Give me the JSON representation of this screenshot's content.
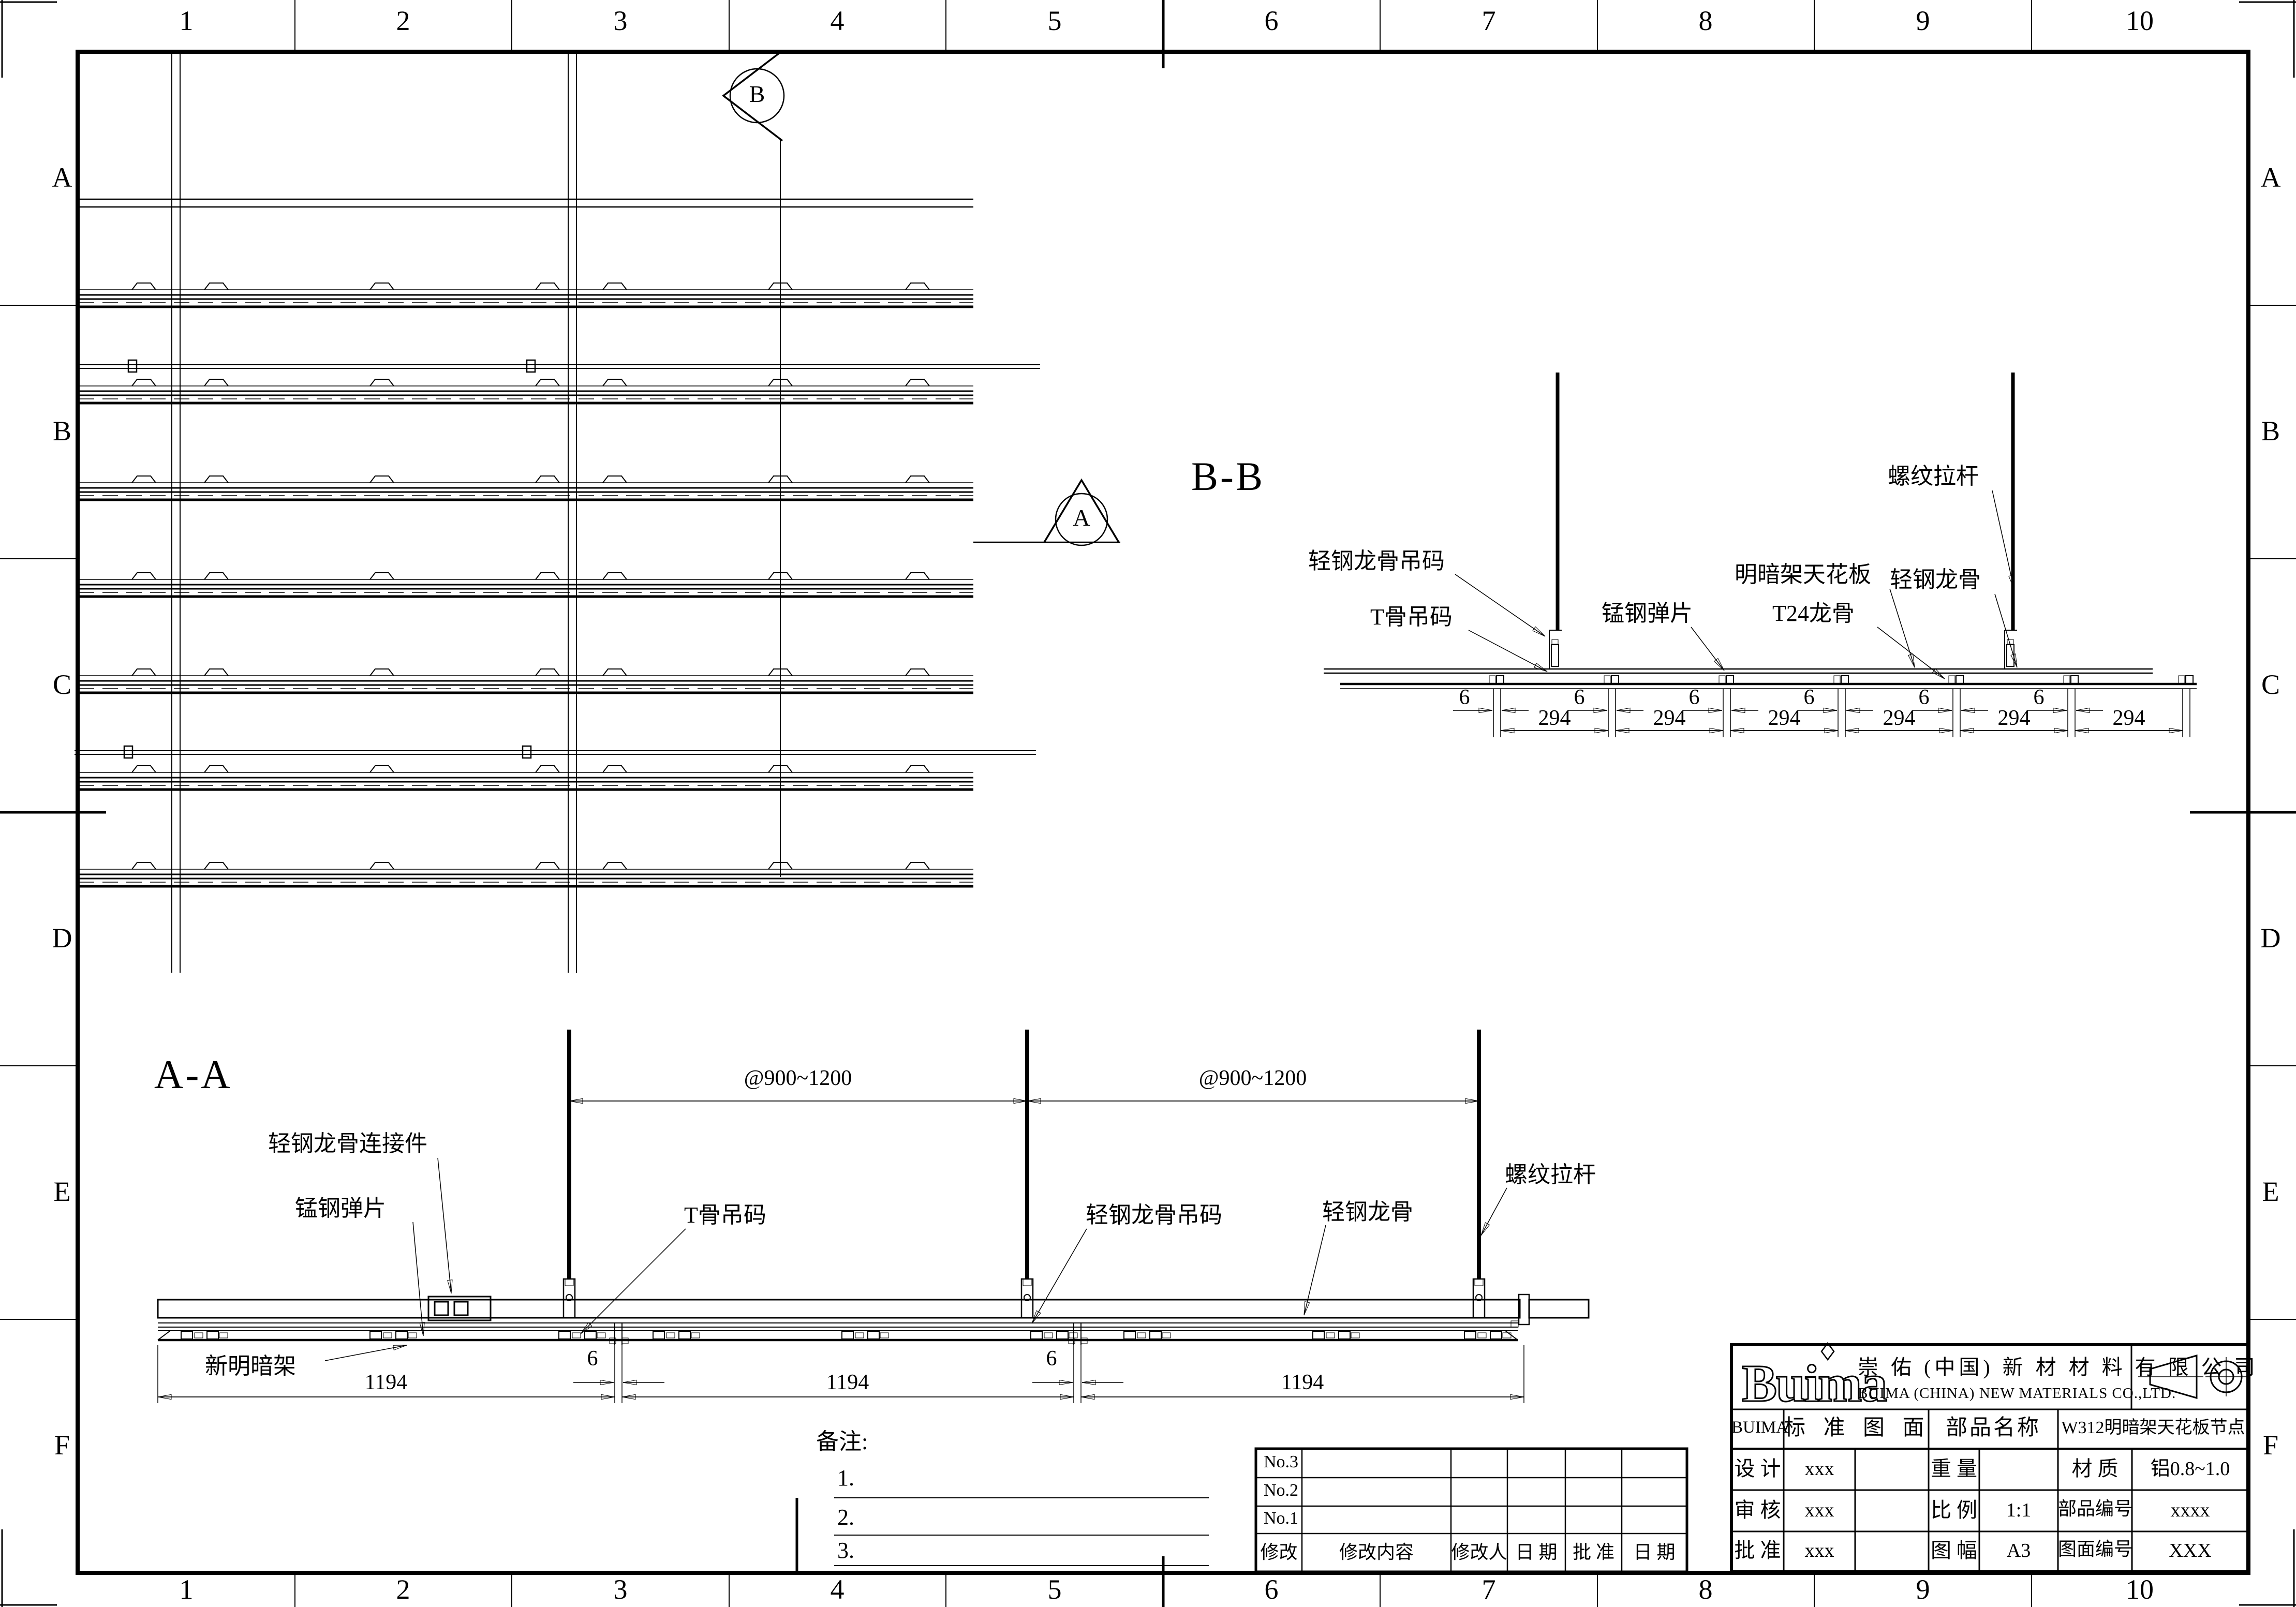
{
  "ink": "#000000",
  "paper": "#ffffff",
  "grid": {
    "cols": [
      "1",
      "2",
      "3",
      "4",
      "5",
      "6",
      "7",
      "8",
      "9",
      "10"
    ],
    "rows": [
      "A",
      "B",
      "C",
      "D",
      "E",
      "F"
    ]
  },
  "plan": {
    "section_marker_b": "B",
    "section_marker_a": "A"
  },
  "bb": {
    "title": "B-B",
    "labels": {
      "keel_hanger": "轻钢龙骨吊码",
      "tbar_hanger": "T骨吊码",
      "spring_clip": "锰钢弹片",
      "ceiling_panel": "明暗架天花板",
      "t24_runner": "T24龙骨",
      "threaded_rod": "螺纹拉杆",
      "steel_keel": "轻钢龙骨"
    },
    "dim_6": "6",
    "dim_294": "294"
  },
  "aa": {
    "title": "A-A",
    "labels": {
      "keel_connector": "轻钢龙骨连接件",
      "spring_clip": "锰钢弹片",
      "tbar_hanger": "T骨吊码",
      "keel_hanger": "轻钢龙骨吊码",
      "steel_keel": "轻钢龙骨",
      "threaded_rod": "螺纹拉杆",
      "new_frame": "新明暗架"
    },
    "dim_span": "@900~1200",
    "dim_1194": "1194",
    "dim_6": "6"
  },
  "notes": {
    "title": "备注:",
    "item1": "1.",
    "item2": "2.",
    "item3": "3."
  },
  "revision": {
    "rows": [
      "No.3",
      "No.2",
      "No.1"
    ],
    "headers": [
      "修改",
      "修改内容",
      "修改人",
      "日 期",
      "批 准",
      "日 期"
    ]
  },
  "title_block": {
    "logo": "Buima",
    "company_cn": "崇 佑 (中国) 新 材 材 料 有 限 公 司",
    "company_en": "BUIMA (CHINA) NEW MATERIALS CO.,LTD.",
    "brand": "BUIMA",
    "std_drawing": "标 准 图 面",
    "part_name_label": "部品名称",
    "part_name": "W312明暗架天花板节点",
    "design_label": "设 计",
    "design_value": "xxx",
    "weight_label": "重 量",
    "weight_value": "",
    "material_label": "材  质",
    "material_value": "铝0.8~1.0",
    "check_label": "审 核",
    "check_value": "xxx",
    "scale_label": "比 例",
    "scale_value": "1:1",
    "part_no_label": "部品编号",
    "part_no_value": "xxxx",
    "approve_label": "批 准",
    "approve_value": "xxx",
    "size_label": "图 幅",
    "size_value": "A3",
    "dwg_no_label": "图面编号",
    "dwg_no_value": "XXX"
  }
}
